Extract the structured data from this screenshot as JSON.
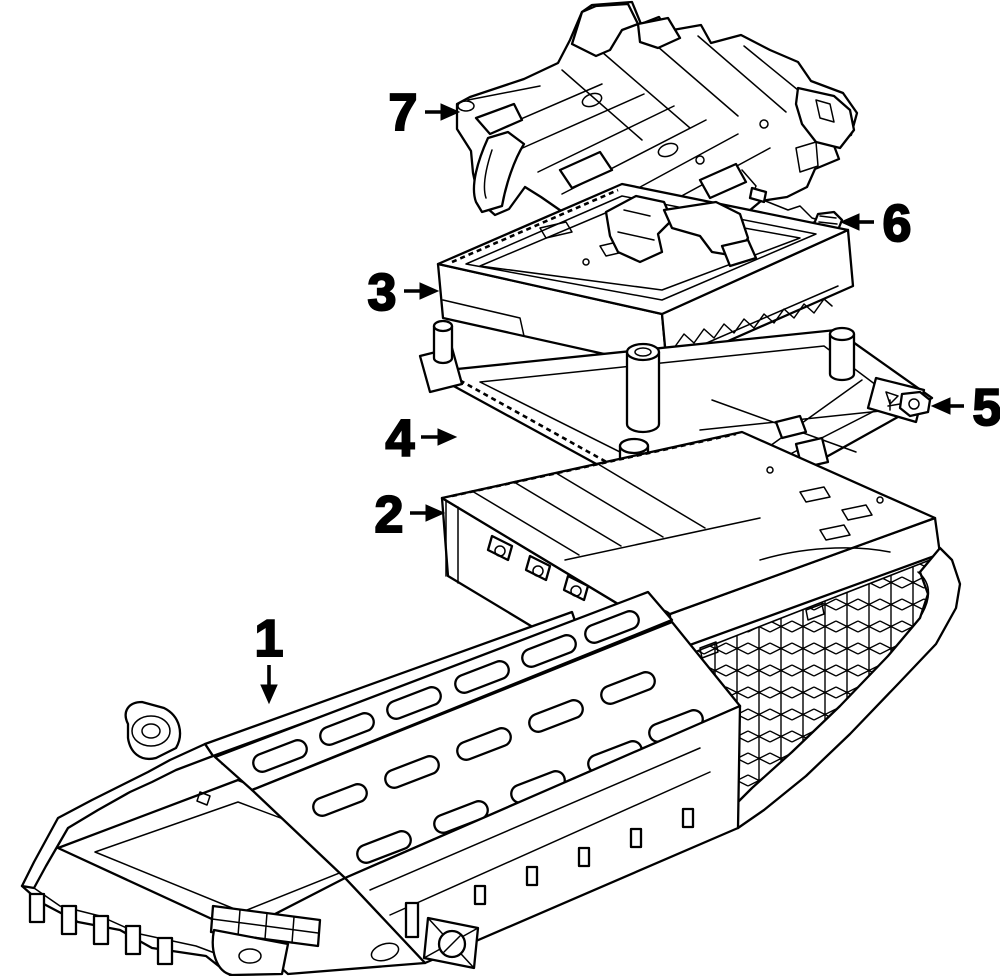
{
  "diagram": {
    "background_color": "#ffffff",
    "line_color": "#000000",
    "style": "black-and-white exploded parts line drawing"
  },
  "callouts": [
    {
      "label": "1"
    },
    {
      "label": "2"
    },
    {
      "label": "3"
    },
    {
      "label": "4"
    },
    {
      "label": "5"
    },
    {
      "label": "6"
    },
    {
      "label": "7"
    }
  ]
}
